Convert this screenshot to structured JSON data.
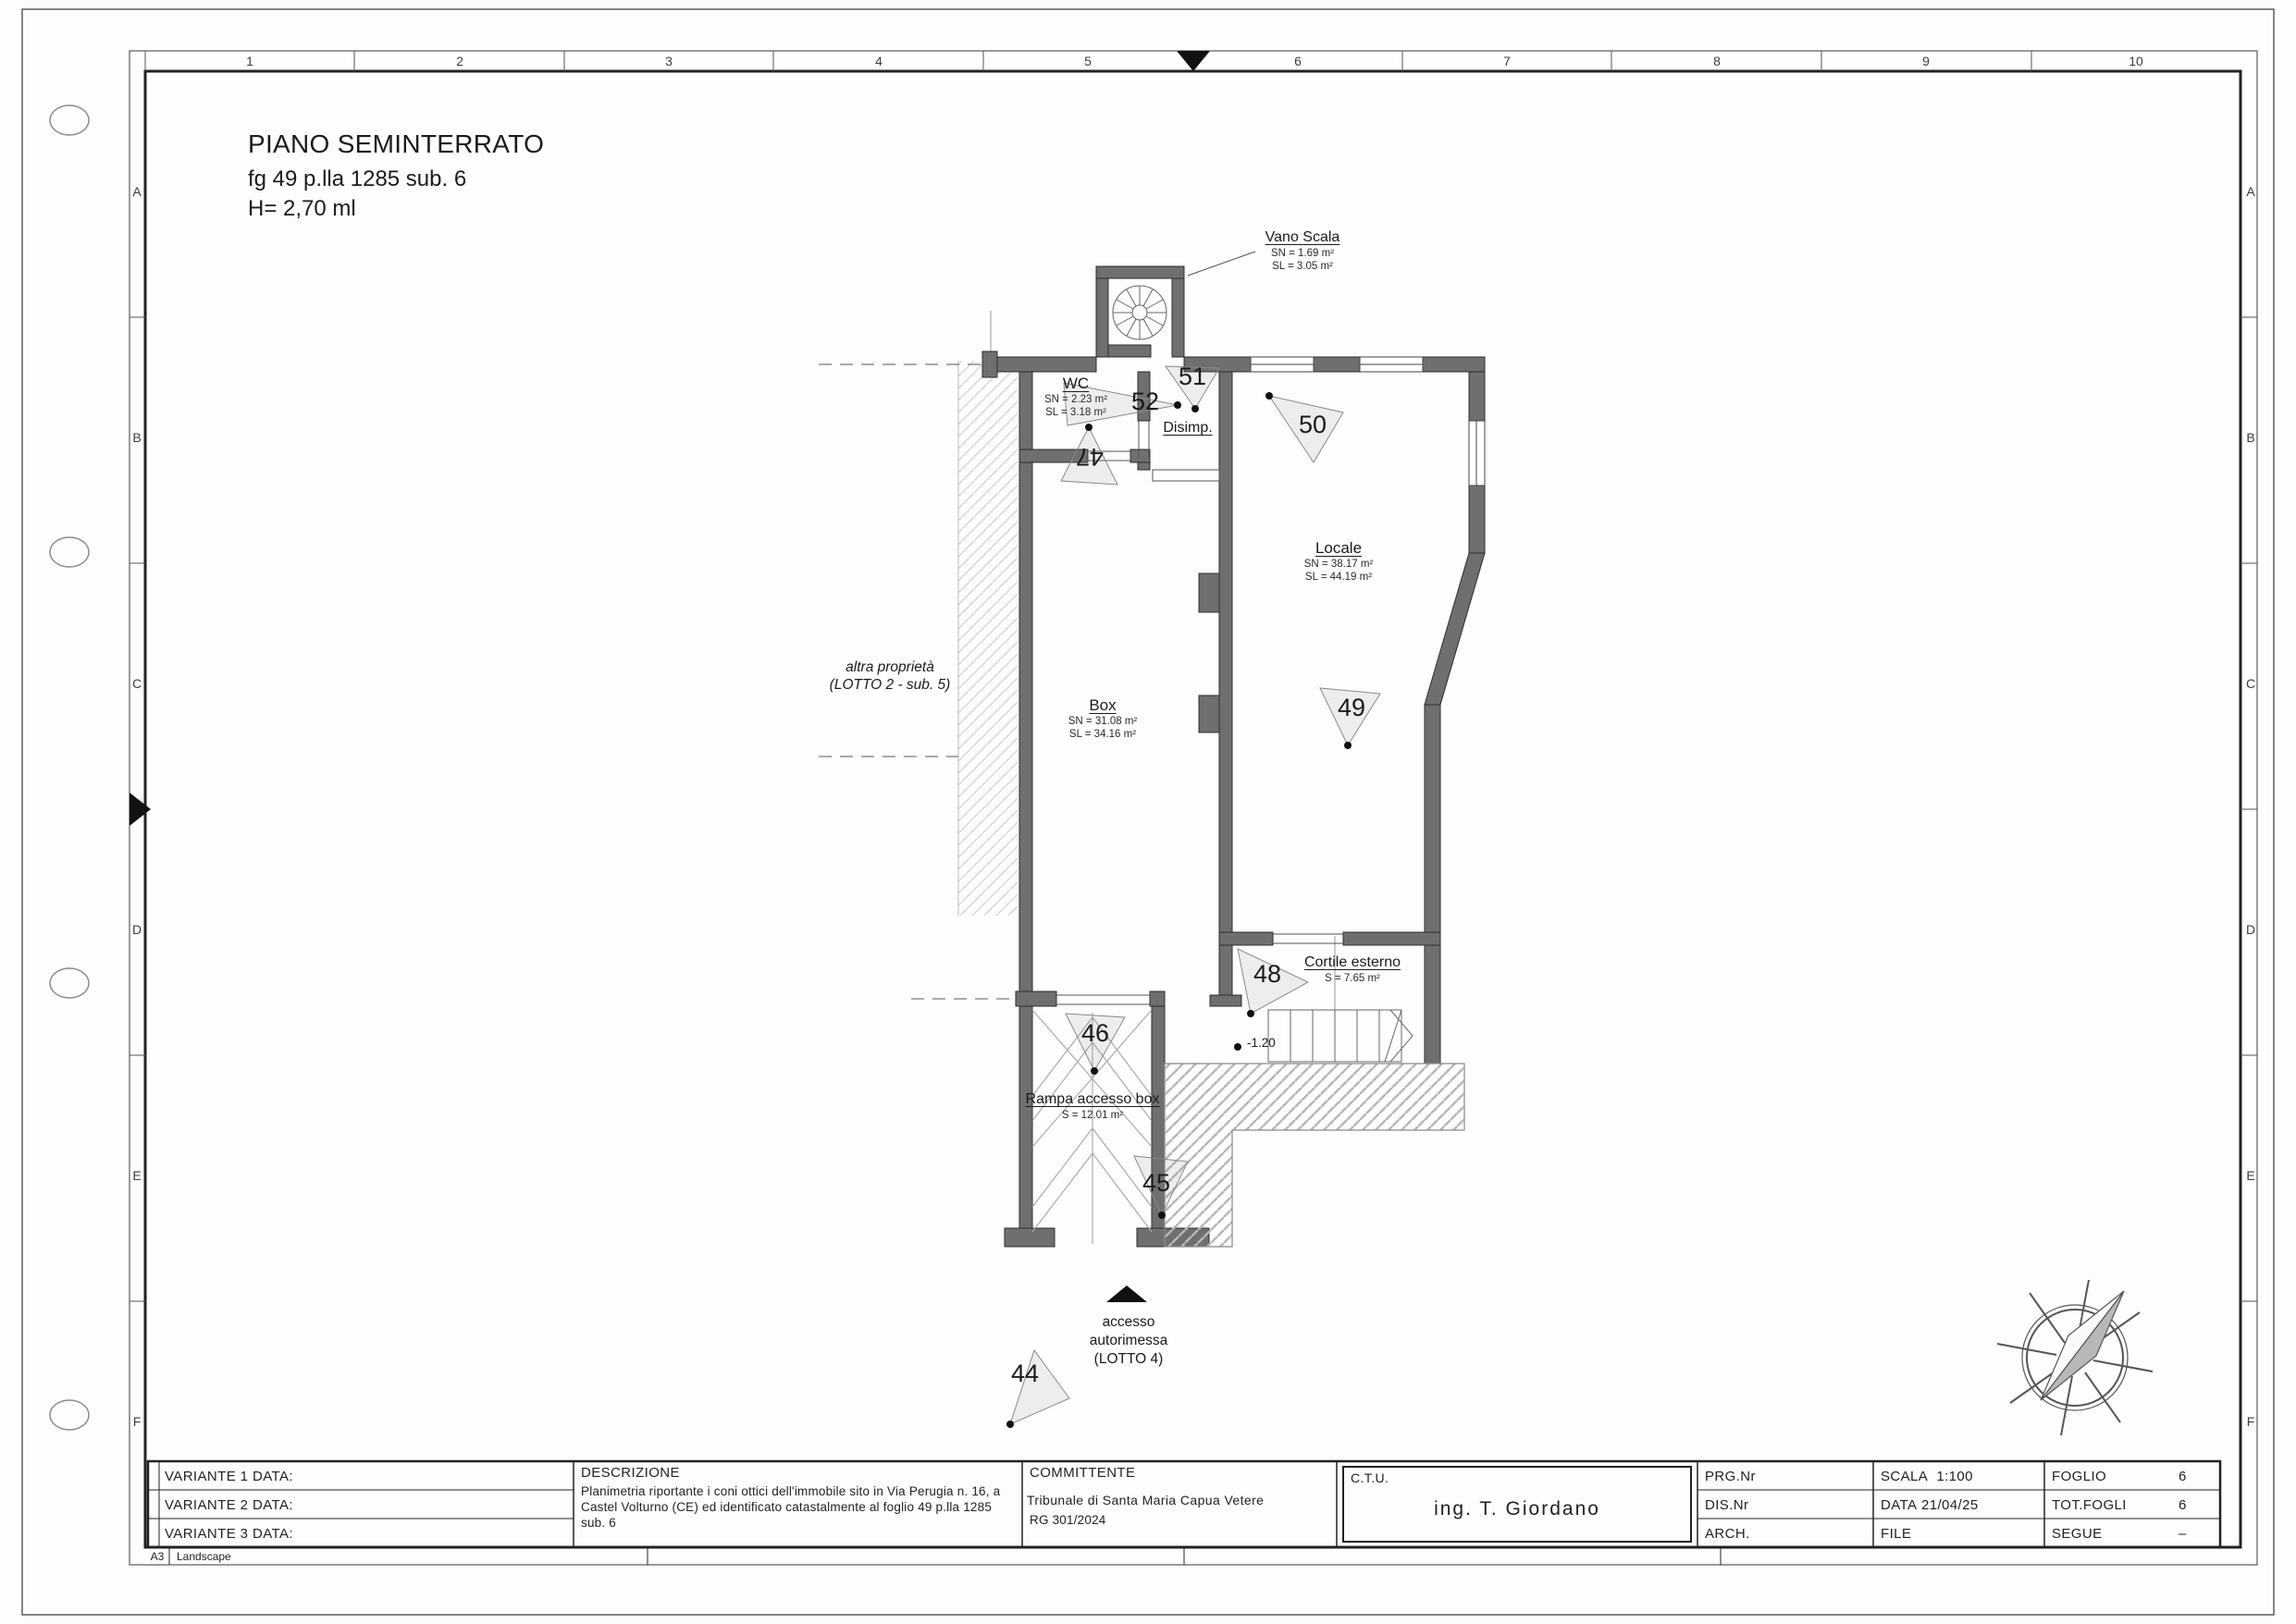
{
  "sheet": {
    "title": [
      "PIANO SEMINTERRATO",
      "fg 49 p.lla 1285 sub. 6",
      "H= 2,70 ml"
    ],
    "cols": [
      "1",
      "2",
      "3",
      "4",
      "5",
      "6",
      "7",
      "8",
      "9",
      "10"
    ],
    "rows": [
      "A",
      "B",
      "C",
      "D",
      "E",
      "F"
    ],
    "paper": "A3",
    "orientation": "Landscape"
  },
  "plan": {
    "vano_scala": {
      "name": "Vano Scala",
      "sn": "SN = 1.69 m²",
      "sl": "SL = 3.05 m²"
    },
    "wc": {
      "name": "WC",
      "sn": "SN = 2.23 m²",
      "sl": "SL = 3.18 m²"
    },
    "disimp": {
      "name": "Disimp."
    },
    "locale": {
      "name": "Locale",
      "sn": "SN = 38.17 m²",
      "sl": "SL = 44.19 m²"
    },
    "box": {
      "name": "Box",
      "sn": "SN = 31.08 m²",
      "sl": "SL = 34.16 m²"
    },
    "cortile": {
      "name": "Cortile esterno",
      "s": "S = 7.65 m²"
    },
    "rampa": {
      "name": "Rampa accesso box",
      "s": "S = 12.01 m²"
    },
    "altra_proprieta": {
      "line1": "altra proprietà",
      "line2": "(LOTTO 2 - sub. 5)"
    },
    "accesso": {
      "line1": "accesso",
      "line2": "autorimessa",
      "line3": "(LOTTO 4)"
    },
    "level": "-1.20",
    "cones": {
      "n44": "44",
      "n45": "45",
      "n46": "46",
      "n47": "47",
      "n48": "48",
      "n49": "49",
      "n50": "50",
      "n51": "51",
      "n52": "52"
    }
  },
  "titleblock": {
    "variante1": "VARIANTE 1 DATA:",
    "variante2": "VARIANTE 2 DATA:",
    "variante3": "VARIANTE 3 DATA:",
    "descrizione_label": "DESCRIZIONE",
    "descrizione_text": "Planimetria riportante i coni ottici dell'immobile sito in Via Perugia n. 16, a Castel Volturno (CE) ed identificato catastalmente al foglio 49 p.lla 1285 sub. 6",
    "committente_label": "COMMITTENTE",
    "committente_name": "Tribunale di Santa Maria Capua Vetere",
    "committente_rg": "RG 301/2024",
    "ctu_label": "C.T.U.",
    "ctu_name": "ing. T. Giordano",
    "prg_label": "PRG.Nr",
    "dis_label": "DIS.Nr",
    "arch_label": "ARCH.",
    "scala_label": "SCALA",
    "scala_value": "1:100",
    "data_label": "DATA",
    "data_value": "21/04/25",
    "file_label": "FILE",
    "foglio_label": "FOGLIO",
    "foglio_value": "6",
    "totfogli_label": "TOT.FOGLI",
    "totfogli_value": "6",
    "segue_label": "SEGUE",
    "segue_value": "–"
  }
}
